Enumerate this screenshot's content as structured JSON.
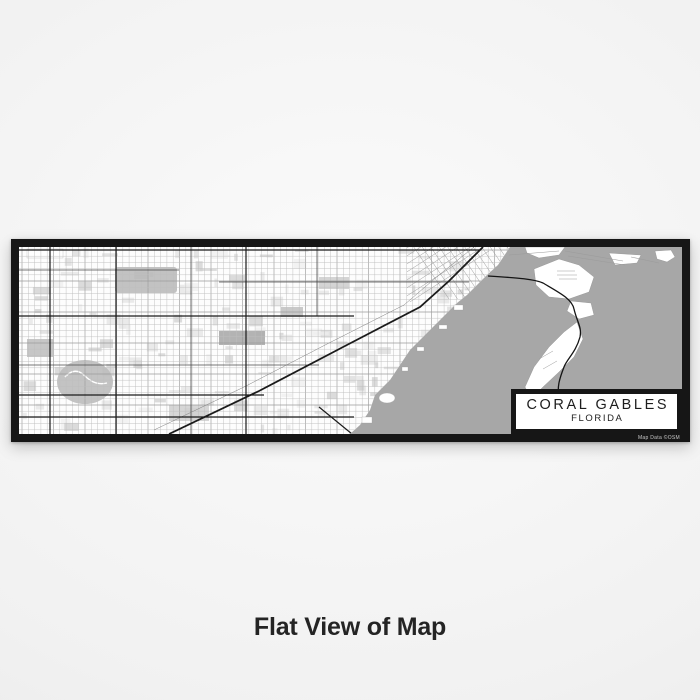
{
  "page": {
    "caption": "Flat View of Map"
  },
  "map_print": {
    "city": "CORAL GABLES",
    "state": "FLORIDA",
    "credit": "Map Data ©OSM",
    "colors": {
      "frame": "#161616",
      "land": "#fdfdfd",
      "water": "#a7a7a7",
      "road_major": "#1b1b1b",
      "road_medium": "#4a4a4a",
      "road_minor": "#bdbdbd",
      "road_minor_dark": "#9b9b9b",
      "label_text": "#1d1d1d",
      "block_shades": [
        "#ededed",
        "#e3e3e3",
        "#d9d9d9",
        "#cfcfcf"
      ]
    }
  }
}
